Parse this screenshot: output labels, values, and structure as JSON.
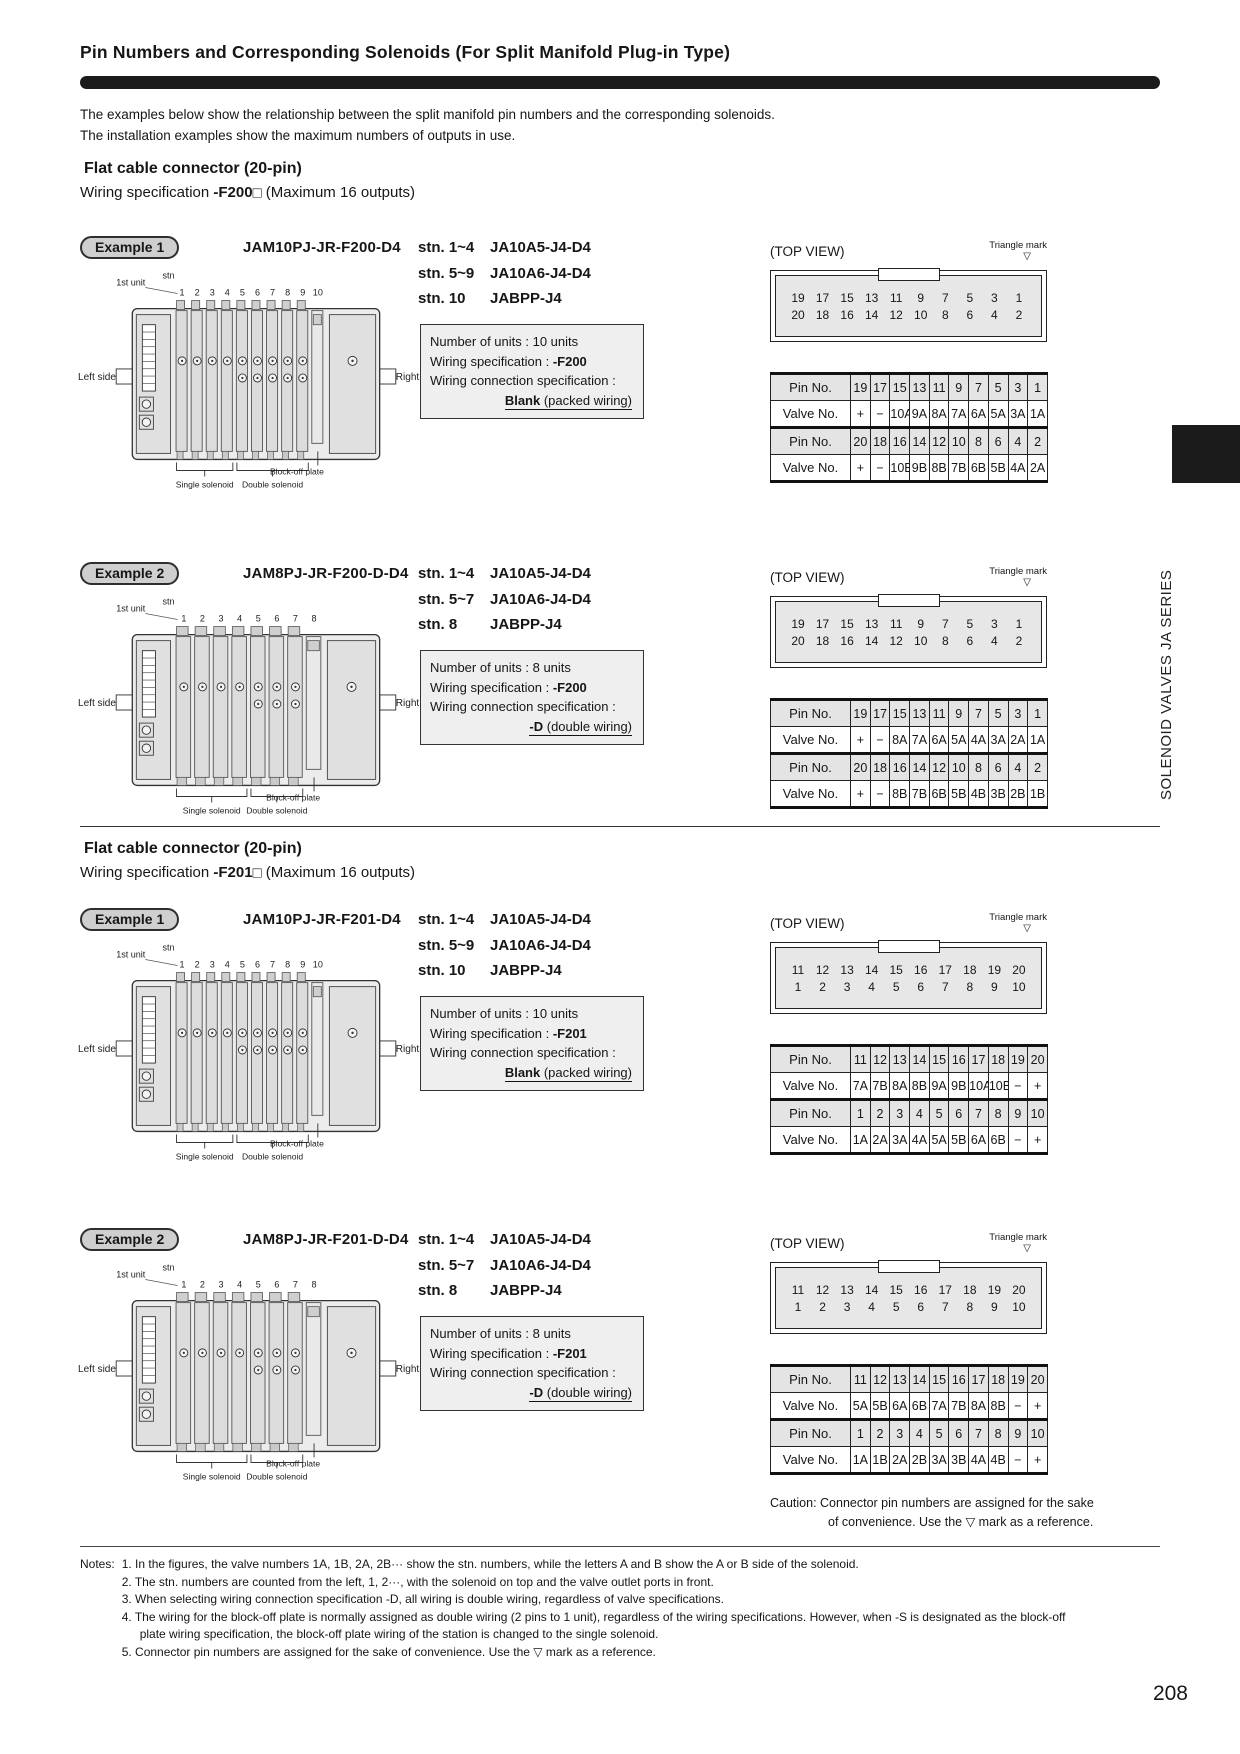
{
  "colors": {
    "title_bar": "#1b1b1b",
    "pin_row_bg": "#e4e4e4",
    "spec_box_bg": "#efefef",
    "badge_bg": "#cfcfcf",
    "connector_bg": "#e7e7e7",
    "side_tab_bg": "#1b1b1b"
  },
  "page": {
    "title": "Pin Numbers and Corresponding Solenoids (For Split Manifold Plug-in Type)",
    "intro_line1": "The examples below show the relationship between the split manifold pin numbers and the corresponding solenoids.",
    "intro_line2": "The installation examples show the maximum numbers of outputs in use.",
    "page_number": "208",
    "side_tab_text": "SOLENOID VALVES JA SERIES"
  },
  "shared": {
    "top_view": "(TOP VIEW)",
    "triangle_mark": "Triangle mark",
    "triangle_symbol": "▽"
  },
  "diagram_labels": {
    "first_unit": "1st unit",
    "stn": "stn",
    "left": "Left side",
    "right": "Right side",
    "single": "Single solenoid",
    "double": "Double solenoid",
    "blockoff": "Block-off plate"
  },
  "sections": [
    {
      "heading": "Flat cable connector (20-pin)",
      "wiring_pre": "Wiring specification ",
      "code": "-F200",
      "box": "□",
      "post": " (Maximum 16 outputs)"
    },
    {
      "heading": "Flat cable connector (20-pin)",
      "wiring_pre": "Wiring specification ",
      "code": "-F201",
      "box": "□",
      "post": " (Maximum 16 outputs)"
    }
  ],
  "examples": [
    {
      "badge": "Example 1",
      "model": "JAM10PJ-JR-F200-D4",
      "stn": [
        {
          "range": "stn. 1~4",
          "model": "JA10A5-J4-D4"
        },
        {
          "range": "stn. 5~9",
          "model": "JA10A6-J4-D4"
        },
        {
          "range": "stn. 10",
          "model": "JABPP-J4"
        }
      ],
      "spec": {
        "units": "Number of units : 10 units",
        "wiring_pre": "Wiring specification : ",
        "wiring_code": "-F200",
        "conn_label": "Wiring connection specification :",
        "conn_bold": "Blank",
        "conn_rest": " (packed wiring)"
      },
      "connector_rows": [
        [
          "19",
          "17",
          "15",
          "13",
          "11",
          "9",
          "7",
          "5",
          "3",
          "1"
        ],
        [
          "20",
          "18",
          "16",
          "14",
          "12",
          "10",
          "8",
          "6",
          "4",
          "2"
        ]
      ],
      "table": {
        "rows": [
          {
            "label": "Pin No.",
            "type": "pin",
            "values": [
              "19",
              "17",
              "15",
              "13",
              "11",
              "9",
              "7",
              "5",
              "3",
              "1"
            ]
          },
          {
            "label": "Valve No.",
            "type": "valve",
            "values": [
              "+",
              "−",
              "10A",
              "9A",
              "8A",
              "7A",
              "6A",
              "5A",
              "3A",
              "1A"
            ]
          },
          {
            "label": "Pin No.",
            "type": "pin",
            "values": [
              "20",
              "18",
              "16",
              "14",
              "12",
              "10",
              "8",
              "6",
              "4",
              "2"
            ]
          },
          {
            "label": "Valve No.",
            "type": "valve",
            "values": [
              "+",
              "−",
              "10B",
              "9B",
              "8B",
              "7B",
              "6B",
              "5B",
              "4A",
              "2A"
            ]
          }
        ]
      },
      "diagram": {
        "units": 10,
        "singles": 4
      }
    },
    {
      "badge": "Example 2",
      "model": "JAM8PJ-JR-F200-D-D4",
      "stn": [
        {
          "range": "stn. 1~4",
          "model": "JA10A5-J4-D4"
        },
        {
          "range": "stn. 5~7",
          "model": "JA10A6-J4-D4"
        },
        {
          "range": "stn. 8",
          "model": "JABPP-J4"
        }
      ],
      "spec": {
        "units": "Number of units : 8 units",
        "wiring_pre": "Wiring specification : ",
        "wiring_code": "-F200",
        "conn_label": "Wiring connection specification :",
        "conn_bold": "-D",
        "conn_rest": " (double wiring)"
      },
      "connector_rows": [
        [
          "19",
          "17",
          "15",
          "13",
          "11",
          "9",
          "7",
          "5",
          "3",
          "1"
        ],
        [
          "20",
          "18",
          "16",
          "14",
          "12",
          "10",
          "8",
          "6",
          "4",
          "2"
        ]
      ],
      "table": {
        "rows": [
          {
            "label": "Pin No.",
            "type": "pin",
            "values": [
              "19",
              "17",
              "15",
              "13",
              "11",
              "9",
              "7",
              "5",
              "3",
              "1"
            ]
          },
          {
            "label": "Valve No.",
            "type": "valve",
            "values": [
              "+",
              "−",
              "8A",
              "7A",
              "6A",
              "5A",
              "4A",
              "3A",
              "2A",
              "1A"
            ]
          },
          {
            "label": "Pin No.",
            "type": "pin",
            "values": [
              "20",
              "18",
              "16",
              "14",
              "12",
              "10",
              "8",
              "6",
              "4",
              "2"
            ]
          },
          {
            "label": "Valve No.",
            "type": "valve",
            "values": [
              "+",
              "−",
              "8B",
              "7B",
              "6B",
              "5B",
              "4B",
              "3B",
              "2B",
              "1B"
            ]
          }
        ]
      },
      "diagram": {
        "units": 8,
        "singles": 4
      }
    },
    {
      "badge": "Example 1",
      "model": "JAM10PJ-JR-F201-D4",
      "stn": [
        {
          "range": "stn. 1~4",
          "model": "JA10A5-J4-D4"
        },
        {
          "range": "stn. 5~9",
          "model": "JA10A6-J4-D4"
        },
        {
          "range": "stn. 10",
          "model": "JABPP-J4"
        }
      ],
      "spec": {
        "units": "Number of units : 10 units",
        "wiring_pre": "Wiring specification : ",
        "wiring_code": "-F201",
        "conn_label": "Wiring connection specification :",
        "conn_bold": "Blank",
        "conn_rest": " (packed wiring)"
      },
      "connector_rows": [
        [
          "11",
          "12",
          "13",
          "14",
          "15",
          "16",
          "17",
          "18",
          "19",
          "20"
        ],
        [
          "1",
          "2",
          "3",
          "4",
          "5",
          "6",
          "7",
          "8",
          "9",
          "10"
        ]
      ],
      "table": {
        "rows": [
          {
            "label": "Pin No.",
            "type": "pin",
            "values": [
              "11",
              "12",
              "13",
              "14",
              "15",
              "16",
              "17",
              "18",
              "19",
              "20"
            ]
          },
          {
            "label": "Valve No.",
            "type": "valve",
            "values": [
              "7A",
              "7B",
              "8A",
              "8B",
              "9A",
              "9B",
              "10A",
              "10B",
              "−",
              "+"
            ]
          },
          {
            "label": "Pin No.",
            "type": "pin",
            "values": [
              "1",
              "2",
              "3",
              "4",
              "5",
              "6",
              "7",
              "8",
              "9",
              "10"
            ]
          },
          {
            "label": "Valve No.",
            "type": "valve",
            "values": [
              "1A",
              "2A",
              "3A",
              "4A",
              "5A",
              "5B",
              "6A",
              "6B",
              "−",
              "+"
            ]
          }
        ]
      },
      "diagram": {
        "units": 10,
        "singles": 4
      }
    },
    {
      "badge": "Example 2",
      "model": "JAM8PJ-JR-F201-D-D4",
      "stn": [
        {
          "range": "stn. 1~4",
          "model": "JA10A5-J4-D4"
        },
        {
          "range": "stn. 5~7",
          "model": "JA10A6-J4-D4"
        },
        {
          "range": "stn. 8",
          "model": "JABPP-J4"
        }
      ],
      "spec": {
        "units": "Number of units : 8 units",
        "wiring_pre": "Wiring specification : ",
        "wiring_code": "-F201",
        "conn_label": "Wiring connection specification :",
        "conn_bold": "-D",
        "conn_rest": " (double wiring)"
      },
      "connector_rows": [
        [
          "11",
          "12",
          "13",
          "14",
          "15",
          "16",
          "17",
          "18",
          "19",
          "20"
        ],
        [
          "1",
          "2",
          "3",
          "4",
          "5",
          "6",
          "7",
          "8",
          "9",
          "10"
        ]
      ],
      "table": {
        "rows": [
          {
            "label": "Pin No.",
            "type": "pin",
            "values": [
              "11",
              "12",
              "13",
              "14",
              "15",
              "16",
              "17",
              "18",
              "19",
              "20"
            ]
          },
          {
            "label": "Valve No.",
            "type": "valve",
            "values": [
              "5A",
              "5B",
              "6A",
              "6B",
              "7A",
              "7B",
              "8A",
              "8B",
              "−",
              "+"
            ]
          },
          {
            "label": "Pin No.",
            "type": "pin",
            "values": [
              "1",
              "2",
              "3",
              "4",
              "5",
              "6",
              "7",
              "8",
              "9",
              "10"
            ]
          },
          {
            "label": "Valve No.",
            "type": "valve",
            "values": [
              "1A",
              "1B",
              "2A",
              "2B",
              "3A",
              "3B",
              "4A",
              "4B",
              "−",
              "+"
            ]
          }
        ]
      },
      "diagram": {
        "units": 8,
        "singles": 4
      }
    }
  ],
  "caution": {
    "line1": "Caution: Connector pin numbers are assigned for the sake",
    "line2": "of convenience. Use the ▽ mark as a reference."
  },
  "notes": {
    "label": "Notes:",
    "items": [
      "1. In the figures, the valve numbers 1A, 1B, 2A, 2B··· show the stn. numbers, while the letters A and B show the A or B side of the solenoid.",
      "2. The stn. numbers are counted from the left, 1, 2···, with the solenoid on top and the valve outlet ports in front.",
      "3. When selecting wiring connection specification -D, all wiring is double wiring, regardless of valve specifications.",
      "4. The wiring for the block-off plate is normally assigned as double wiring (2 pins to 1 unit), regardless of the wiring specifications. However, when -S is designated as the block-off plate wiring specification, the block-off plate wiring of the station is changed to the single solenoid.",
      "5. Connector pin numbers are assigned for the sake of convenience. Use the ▽ mark as a reference."
    ]
  }
}
